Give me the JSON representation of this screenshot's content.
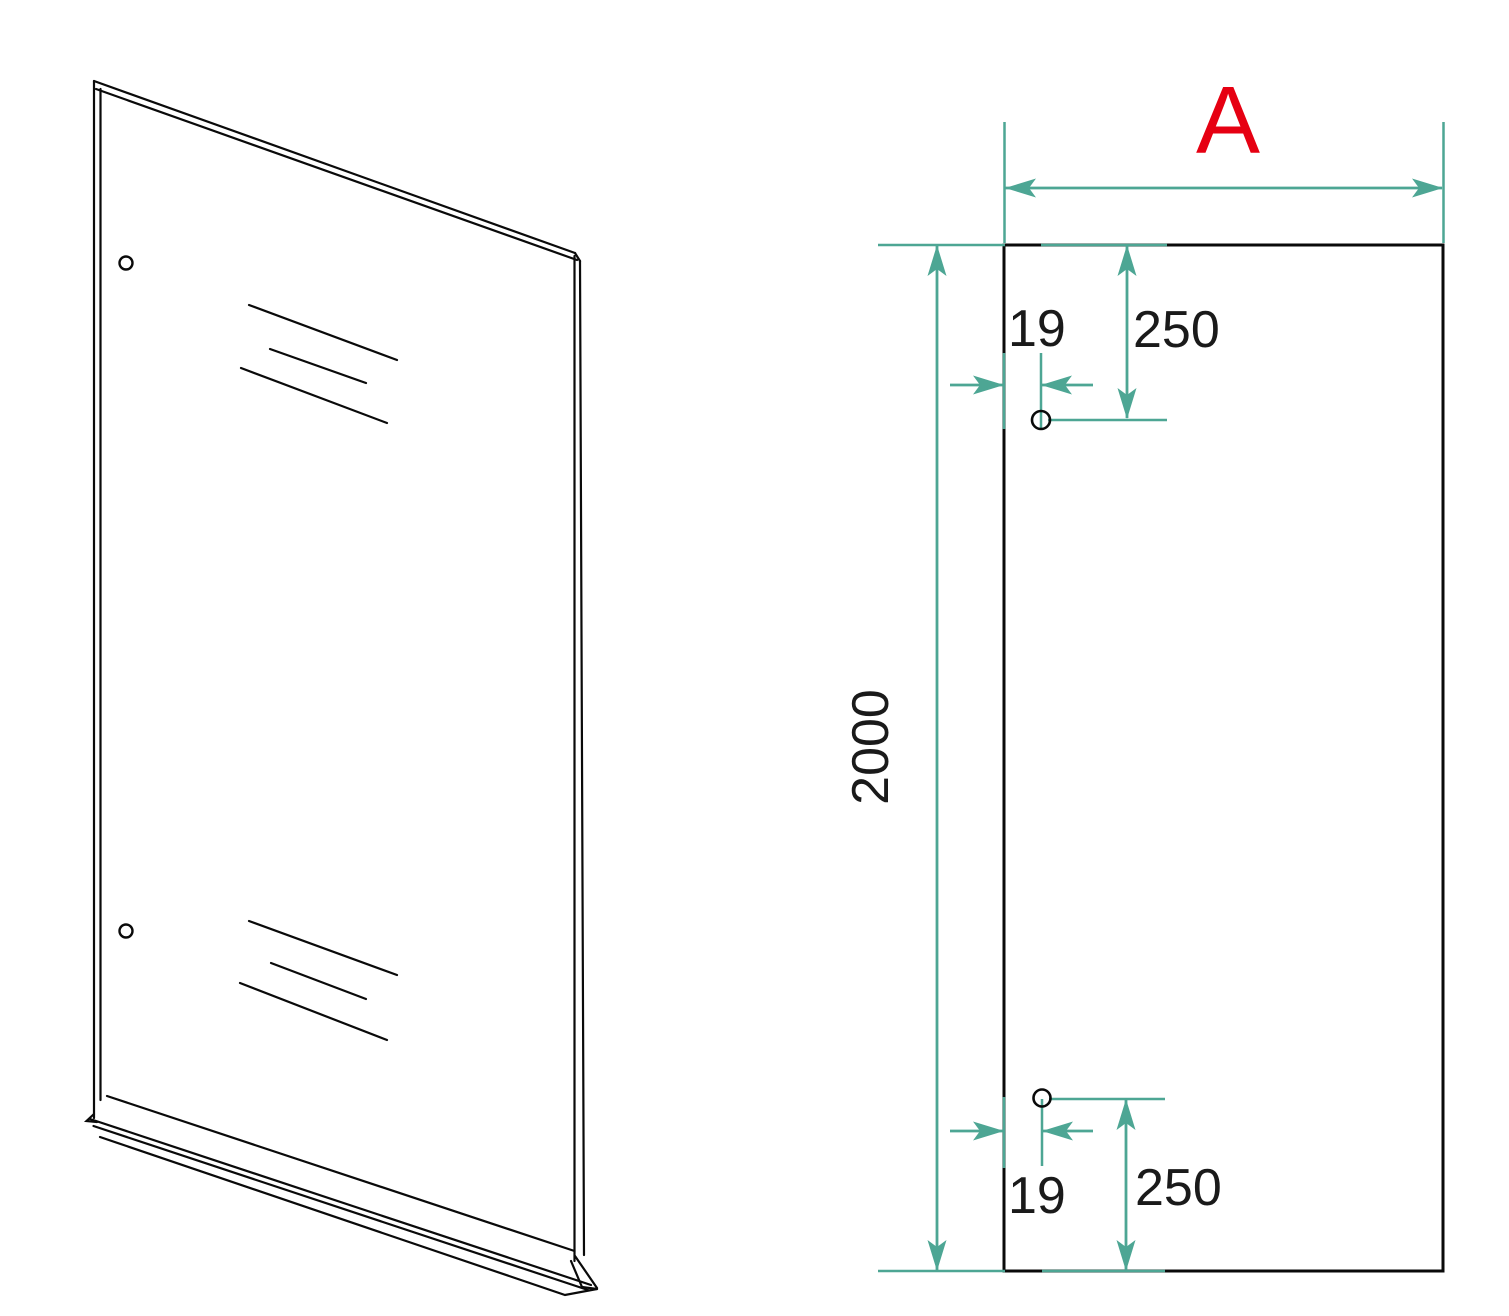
{
  "front_view": {
    "width_label": "A",
    "height_mm": "2000",
    "top_hole": {
      "edge_offset_mm": "19",
      "offset_from_top_mm": "250"
    },
    "bottom_hole": {
      "edge_offset_mm": "19",
      "offset_from_bottom_mm": "250"
    }
  },
  "colors": {
    "dimension_teal": "#4DA694",
    "label_red": "#E60012",
    "line_black": "#0a0a0a",
    "background": "#FFFFFF"
  }
}
